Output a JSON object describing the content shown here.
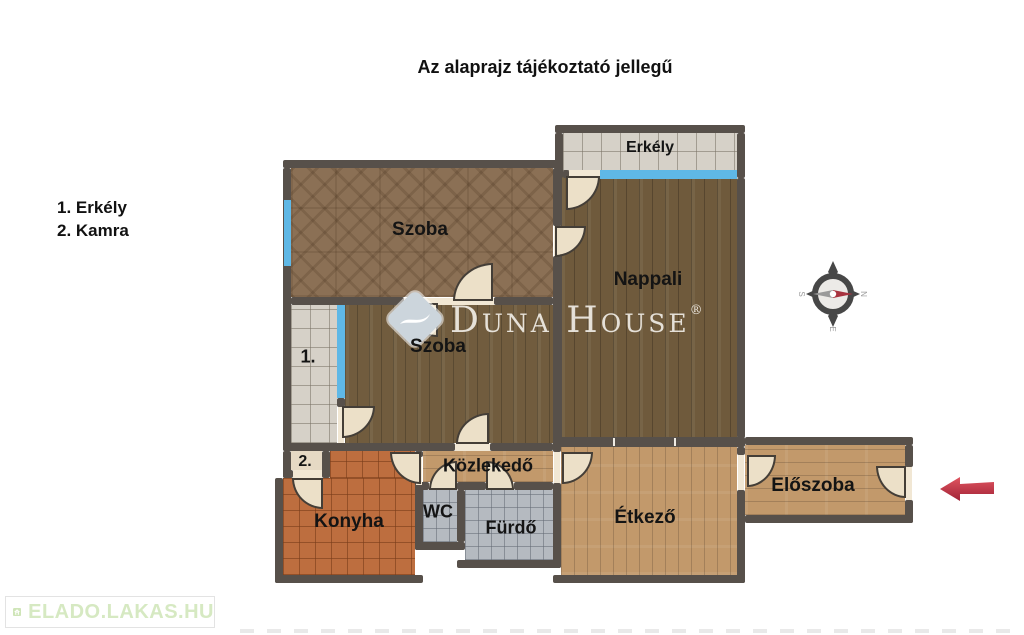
{
  "title": "Az alaprajz tájékoztató jellegű",
  "legend": {
    "items": [
      {
        "label": "1. Erkély"
      },
      {
        "label": "2. Kamra"
      }
    ]
  },
  "rooms": {
    "erkely_top": "Erkély",
    "szoba_top": "Szoba",
    "nappali": "Nappali",
    "szoba_middle": "Szoba",
    "erkely_1": "1.",
    "kamra_2": "2.",
    "konyha": "Konyha",
    "kozlekedo": "Közlekedő",
    "wc": "WC",
    "furdo": "Fürdő",
    "etkezo": "Étkező",
    "eloszoba": "Előszoba"
  },
  "watermark": {
    "brand": "Duna House",
    "registered": "®"
  },
  "compass": {
    "north": "N",
    "south": "S",
    "east": "E",
    "west": "W"
  },
  "footer": {
    "logo_text": "ELADO.LAKAS.HU"
  },
  "colors": {
    "wall": "#57504a",
    "window": "#5fb8e6",
    "door_leaf": "#ece0c8",
    "parquet_dark": "#6f5a3c",
    "parquet_herringbone": "#8b7055",
    "wood_light": "#c2996b",
    "tile_balcony": "#d6d1c8",
    "tile_kitchen": "#bd6e3f",
    "tile_bath": "#b5bac0",
    "kamra_floor": "#e6d9c4",
    "arrow_red": "#c9344a",
    "logo_green": "#d6e9c2"
  }
}
